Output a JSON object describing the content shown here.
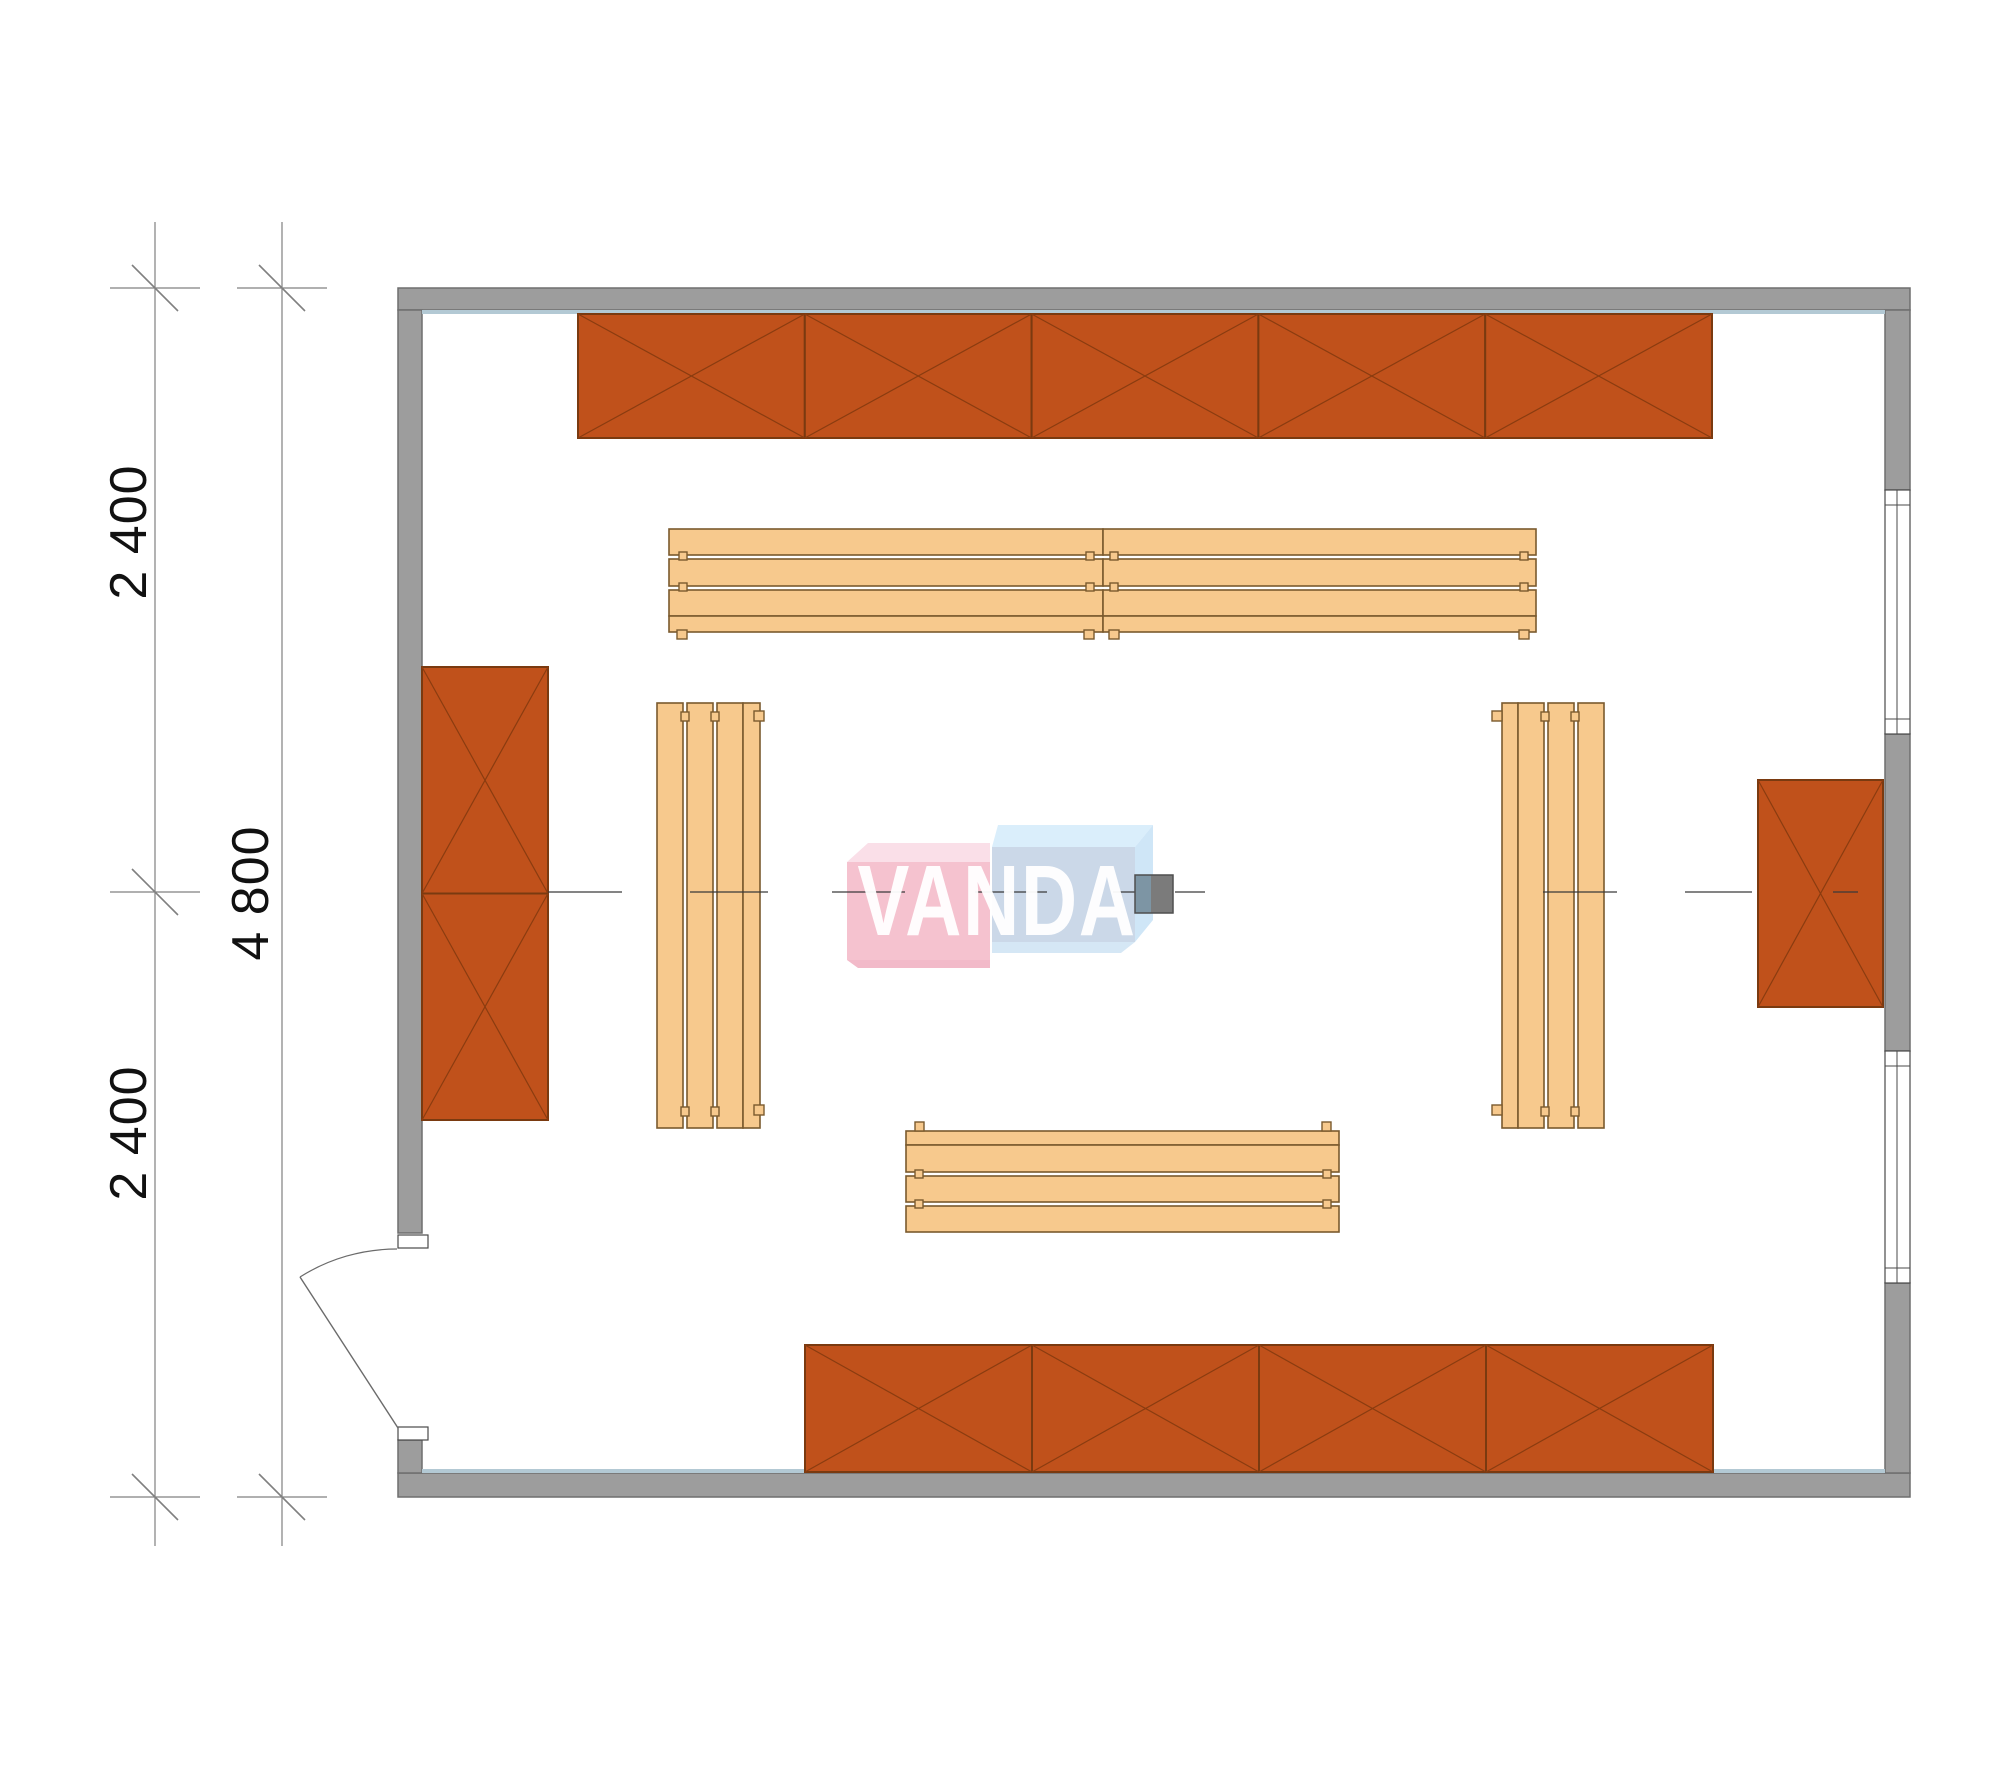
{
  "meta": {
    "width": 2000,
    "height": 1786,
    "background": "#ffffff"
  },
  "colors": {
    "orange_fill": "#c0511b",
    "orange_edge": "#7a3a10",
    "orange_diag": "#8a3c10",
    "wood_fill": "#f7c98d",
    "wood_edge": "#7a5a2e",
    "wall_fill": "#9d9d9d",
    "wall_edge": "#6e6e6e",
    "wall_highlight": "#b3c9d4",
    "window_fill": "#ffffff",
    "window_line": "#4a4a4a",
    "door_line": "#6b6b6b",
    "centerline": "#3a3a3a",
    "dim_line": "#808080",
    "dim_text": "#111111",
    "pink_front": "#f5c2cf",
    "pink_top": "#fadfe8",
    "pink_bottom": "#f2bac9",
    "blue_front": "#cbd8e8",
    "blue_top": "#daeefb",
    "blue_side": "#cfe6f7",
    "blue_bottom": "#d5e7f5",
    "column_left": "#7d95a4",
    "column_right": "#7b7b7b",
    "column_edge": "#4f4f4f"
  },
  "plan": {
    "walls": [
      {
        "name": "wall-top",
        "rect": [
          398,
          288,
          1512,
          22
        ]
      },
      {
        "name": "wall-bottom",
        "rect": [
          398,
          1473,
          1512,
          24
        ]
      },
      {
        "name": "wall-left-upper",
        "rect": [
          398,
          310,
          24,
          923
        ]
      },
      {
        "name": "wall-left-lower",
        "rect": [
          398,
          1440,
          24,
          33
        ]
      },
      {
        "name": "wall-right-upper",
        "rect": [
          1885,
          310,
          25,
          180
        ]
      },
      {
        "name": "wall-right-middle",
        "rect": [
          1885,
          734,
          25,
          317
        ]
      },
      {
        "name": "wall-right-lower",
        "rect": [
          1885,
          1283,
          25,
          190
        ]
      }
    ],
    "highlights": [
      {
        "name": "wall-glazing-line-top",
        "rect": [
          422,
          310,
          1463,
          4
        ]
      },
      {
        "name": "wall-glazing-line-bottom",
        "rect": [
          422,
          1469,
          1463,
          4
        ]
      }
    ],
    "windows": [
      {
        "name": "window-right-upper",
        "rect": [
          1885,
          490,
          25,
          244
        ],
        "mid": 1897,
        "inset": 15
      },
      {
        "name": "window-right-lower",
        "rect": [
          1885,
          1051,
          25,
          232
        ],
        "mid": 1897,
        "inset": 15
      }
    ],
    "cabinets": [
      {
        "name": "cabinet-row-top",
        "x": 578,
        "y": 314,
        "cols": 5,
        "rows": 1,
        "cw": 226.8,
        "ch": 124
      },
      {
        "name": "cabinet-row-bottom",
        "x": 805,
        "y": 1345,
        "cols": 4,
        "rows": 1,
        "cw": 227,
        "ch": 127
      },
      {
        "name": "cabinet-left",
        "x": 422,
        "y": 667,
        "cols": 1,
        "rows": 2,
        "cw": 126,
        "ch": 226.5
      },
      {
        "name": "cabinet-right",
        "x": 1758,
        "y": 780,
        "cols": 1,
        "rows": 1,
        "cw": 125,
        "ch": 227
      }
    ],
    "benches": [
      {
        "name": "bench-top-left",
        "slats": [
          [
            669,
            529,
            434,
            26
          ],
          [
            669,
            559,
            434,
            27
          ],
          [
            669,
            590,
            434,
            26
          ],
          [
            669,
            616,
            434,
            16
          ]
        ],
        "pegs": [
          [
            679,
            552,
            8,
            8
          ],
          [
            679,
            583,
            8,
            8
          ],
          [
            1086,
            552,
            8,
            8
          ],
          [
            1086,
            583,
            8,
            8
          ],
          [
            677,
            630,
            10,
            9
          ],
          [
            1084,
            630,
            10,
            9
          ]
        ]
      },
      {
        "name": "bench-top-right",
        "slats": [
          [
            1103,
            529,
            433,
            26
          ],
          [
            1103,
            559,
            433,
            27
          ],
          [
            1103,
            590,
            433,
            26
          ],
          [
            1103,
            616,
            433,
            16
          ]
        ],
        "pegs": [
          [
            1110,
            552,
            8,
            8
          ],
          [
            1110,
            583,
            8,
            8
          ],
          [
            1520,
            552,
            8,
            8
          ],
          [
            1520,
            583,
            8,
            8
          ],
          [
            1109,
            630,
            10,
            9
          ],
          [
            1519,
            630,
            10,
            9
          ]
        ]
      },
      {
        "name": "bench-bottom",
        "slats": [
          [
            906,
            1131,
            433,
            14
          ],
          [
            906,
            1145,
            433,
            27
          ],
          [
            906,
            1176,
            433,
            26
          ],
          [
            906,
            1206,
            433,
            26
          ]
        ],
        "pegs": [
          [
            915,
            1122,
            9,
            9
          ],
          [
            1322,
            1122,
            9,
            9
          ],
          [
            915,
            1170,
            8,
            8
          ],
          [
            1323,
            1170,
            8,
            8
          ],
          [
            915,
            1200,
            8,
            8
          ],
          [
            1323,
            1200,
            8,
            8
          ]
        ]
      },
      {
        "name": "bench-left",
        "slats": [
          [
            657,
            703,
            26,
            425
          ],
          [
            687,
            703,
            26,
            425
          ],
          [
            717,
            703,
            26,
            425
          ],
          [
            743,
            703,
            17,
            425
          ]
        ],
        "pegs": [
          [
            681,
            712,
            8,
            9
          ],
          [
            711,
            712,
            8,
            9
          ],
          [
            754,
            711,
            10,
            10
          ],
          [
            681,
            1107,
            8,
            9
          ],
          [
            711,
            1107,
            8,
            9
          ],
          [
            754,
            1105,
            10,
            10
          ]
        ]
      },
      {
        "name": "bench-right",
        "slats": [
          [
            1502,
            703,
            16,
            425
          ],
          [
            1518,
            703,
            26,
            425
          ],
          [
            1548,
            703,
            26,
            425
          ],
          [
            1578,
            703,
            26,
            425
          ]
        ],
        "pegs": [
          [
            1541,
            712,
            8,
            9
          ],
          [
            1571,
            712,
            8,
            9
          ],
          [
            1492,
            711,
            10,
            10
          ],
          [
            1541,
            1107,
            8,
            9
          ],
          [
            1571,
            1107,
            8,
            9
          ],
          [
            1492,
            1105,
            10,
            10
          ]
        ]
      }
    ],
    "door": {
      "jambs": [
        [
          398,
          1235,
          30,
          13
        ],
        [
          398,
          1427,
          30,
          13
        ]
      ],
      "leaf": [
        300,
        1277,
        398,
        1428
      ],
      "arc_path": "M 397 1249 A 181 181 0 0 0 300 1277"
    },
    "centerline": {
      "y": 892,
      "segments": [
        [
          548,
          622
        ],
        [
          690,
          768
        ],
        [
          832,
          905
        ],
        [
          975,
          1047
        ],
        [
          1113,
          1135
        ],
        [
          1175,
          1205
        ],
        [
          1543,
          1617
        ],
        [
          1685,
          1752
        ],
        [
          1833,
          1858
        ]
      ]
    },
    "column": {
      "outline": [
        1135,
        875,
        38,
        38
      ],
      "left": [
        1135,
        875,
        16,
        38
      ],
      "right": [
        1151,
        875,
        22,
        38
      ]
    },
    "dimension": {
      "lines": [
        [
          155,
          222,
          1546
        ],
        [
          282,
          222,
          1546
        ]
      ],
      "ticks": [
        [
          155,
          288
        ],
        [
          155,
          892
        ],
        [
          155,
          1497
        ],
        [
          282,
          288
        ],
        [
          282,
          1497
        ]
      ],
      "tick_bar_half": 45,
      "tick_slash_half": 23,
      "labels": [
        {
          "text": "2 400",
          "x": 129,
          "y": 532
        },
        {
          "text": "2 400",
          "x": 129,
          "y": 1133
        },
        {
          "text": "4 800",
          "x": 251,
          "y": 893
        }
      ]
    },
    "watermark": {
      "text": "VANDA",
      "x": 997,
      "y": 906,
      "polys": [
        {
          "name": "watermark-pink-cube-top",
          "fill": "pink_top",
          "pts": "868,843 990,843 990,862 847,862"
        },
        {
          "name": "watermark-pink-cube-front",
          "fill": "pink_front",
          "pts": "847,862 990,862 990,960 847,960"
        },
        {
          "name": "watermark-pink-cube-bottom",
          "fill": "pink_bottom",
          "pts": "847,960 990,960 990,968 858,968"
        },
        {
          "name": "watermark-blue-cube-top",
          "fill": "blue_top",
          "pts": "998,825 1153,825 1135,847 992,847"
        },
        {
          "name": "watermark-blue-cube-side",
          "fill": "blue_side",
          "pts": "1153,825 1153,920 1135,942 1135,847"
        },
        {
          "name": "watermark-blue-cube-front",
          "fill": "blue_front",
          "pts": "992,847 1135,847 1135,942 992,942"
        },
        {
          "name": "watermark-blue-cube-bottom",
          "fill": "blue_bottom",
          "pts": "992,942 1135,942 1121,953 992,953"
        }
      ]
    }
  }
}
